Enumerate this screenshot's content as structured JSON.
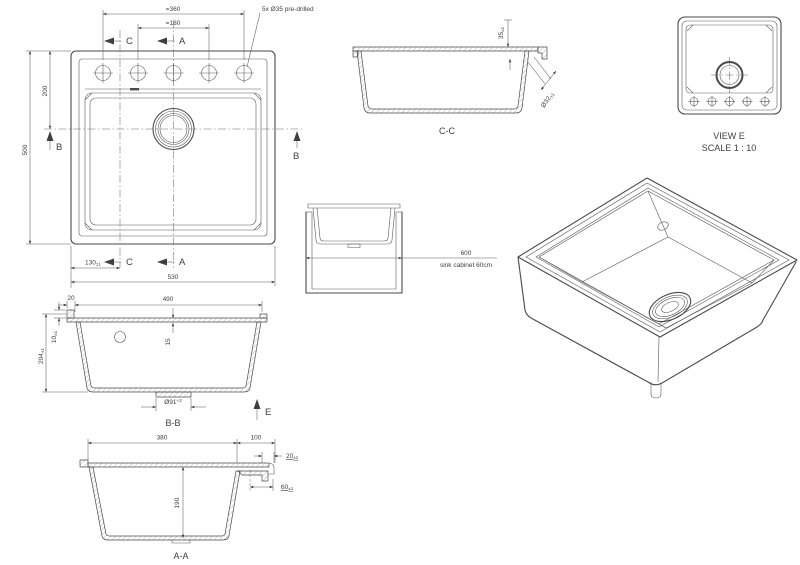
{
  "colors": {
    "line": "#4a4a4a",
    "dim": "#5f5f5f",
    "background": "#ffffff"
  },
  "views": {
    "plan": {
      "top_width": "=360",
      "top_width_inner": "=180",
      "holes_note": "5x Ø35 pre-drilled",
      "height": "500",
      "hole_row_offset": "200",
      "width": "530",
      "c_offset": "130",
      "c_offset_tol": "±1",
      "section_c": "C",
      "section_a": "A",
      "section_b": "B"
    },
    "section_cc": {
      "label": "C-C",
      "deck_drop": "35",
      "deck_drop_tol": "±1",
      "tap_hole": "Ø32",
      "tap_hole_tol": "±1"
    },
    "view_e": {
      "title": "VIEW E",
      "scale": "SCALE 1 : 10"
    },
    "cabinet": {
      "width": "600",
      "caption": "sink cabinet 60cm"
    },
    "section_bb": {
      "label": "B-B",
      "lip_width": "20",
      "inner_width": "490",
      "rim_height": "10",
      "rim_height_tol": "±1",
      "depth": "204",
      "depth_tol": "±1",
      "edge_height": "15",
      "drain_dia": "Ø91",
      "drain_dia_tol": "+2",
      "view_arrow": "E"
    },
    "section_aa": {
      "label": "A-A",
      "bowl_width": "380",
      "deck_width": "100",
      "step": "20",
      "step_tol": "±1",
      "ledge": "60",
      "ledge_tol": "±1",
      "depth": "190"
    }
  }
}
